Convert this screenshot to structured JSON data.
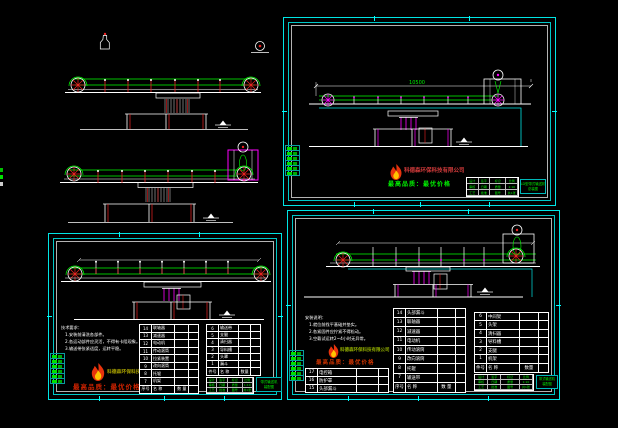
{
  "window": {
    "background": "#000000"
  },
  "colors": {
    "frame_cyan": "#00e5e5",
    "line_white": "#ffffff",
    "belt_green": "#00ff00",
    "roller_red": "#ee2222",
    "support_magenta": "#ff00ff",
    "text_green": "#00ee00",
    "logo_flame": "#e8330c",
    "logo_red": "#cc2200",
    "logo_olive": "#a8a000"
  },
  "logo": {
    "company": "科德森环保科技有限公司",
    "slogan": "最高品质：最优价格"
  },
  "title_block": {
    "cells": [
      "设计",
      "签字",
      "标记",
      "比例",
      "审核",
      "日期",
      "质量",
      "1:10",
      "工艺",
      "批准",
      "图号",
      "共1张"
    ]
  },
  "top_right": {
    "dimension": "10500",
    "label_lines": [
      "LD型带式输送机",
      "总装图"
    ]
  },
  "bottom_left": {
    "notes": [
      "技术要求：",
      "1.安装前清洗各部件。",
      "2.各运动部件应灵活，不得有卡阻现象。",
      "3.输送带张紧适度，运转平稳。"
    ],
    "bom_left": {
      "rows": [
        {
          "no": "14",
          "name": "联轴器"
        },
        {
          "no": "13",
          "name": "减速器"
        },
        {
          "no": "12",
          "name": "电动机"
        },
        {
          "no": "11",
          "name": "传动滚筒"
        },
        {
          "no": "10",
          "name": "拉紧装置"
        },
        {
          "no": "9",
          "name": "改向滚筒"
        },
        {
          "no": "8",
          "name": "托辊"
        },
        {
          "no": "7",
          "name": "机架"
        }
      ],
      "footer": {
        "no": "序号",
        "name": "名  称",
        "qty": "数 量"
      }
    },
    "bom_right": {
      "rows": [
        {
          "no": "6",
          "name": "输送带"
        },
        {
          "no": "5",
          "name": "支腿"
        },
        {
          "no": "4",
          "name": "清扫器"
        },
        {
          "no": "3",
          "name": "导料槽"
        },
        {
          "no": "2",
          "name": "头罩"
        },
        {
          "no": "1",
          "name": "漏斗"
        }
      ],
      "footer": {
        "no": "件号",
        "name": "名  称",
        "qty": "数量"
      }
    },
    "label_lines": [
      "带式输送机",
      "装配图"
    ]
  },
  "bottom_right": {
    "notes": [
      "安装说明：",
      "1.就位前找平基础并垫实。",
      "2.各紧固件应拧紧不得松动。",
      "3.空载试运转2~4小时无异常。"
    ],
    "bom_extra": {
      "rows": [
        {
          "no": "17",
          "name": "电控箱"
        },
        {
          "no": "16",
          "name": "防护罩"
        },
        {
          "no": "15",
          "name": "头部漏斗"
        }
      ]
    },
    "bom_center": {
      "rows": [
        {
          "no": "14",
          "name": "头部漏斗"
        },
        {
          "no": "13",
          "name": "联轴器"
        },
        {
          "no": "12",
          "name": "减速器"
        },
        {
          "no": "11",
          "name": "电动机"
        },
        {
          "no": "10",
          "name": "传动滚筒"
        },
        {
          "no": "9",
          "name": "改向滚筒"
        },
        {
          "no": "8",
          "name": "托辊"
        },
        {
          "no": "7",
          "name": "输送带"
        }
      ],
      "footer": {
        "no": "序号",
        "name": "名  称",
        "qty": "数 量"
      }
    },
    "bom_right": {
      "rows": [
        {
          "no": "6",
          "name": "中间架"
        },
        {
          "no": "5",
          "name": "头架"
        },
        {
          "no": "4",
          "name": "清扫器"
        },
        {
          "no": "3",
          "name": "导料槽"
        },
        {
          "no": "2",
          "name": "支腿"
        },
        {
          "no": "1",
          "name": "机架"
        }
      ],
      "footer": {
        "no": "件号",
        "name": "名  称",
        "qty": "数量"
      }
    },
    "label_lines": [
      "带式输送机",
      "装配图"
    ]
  }
}
